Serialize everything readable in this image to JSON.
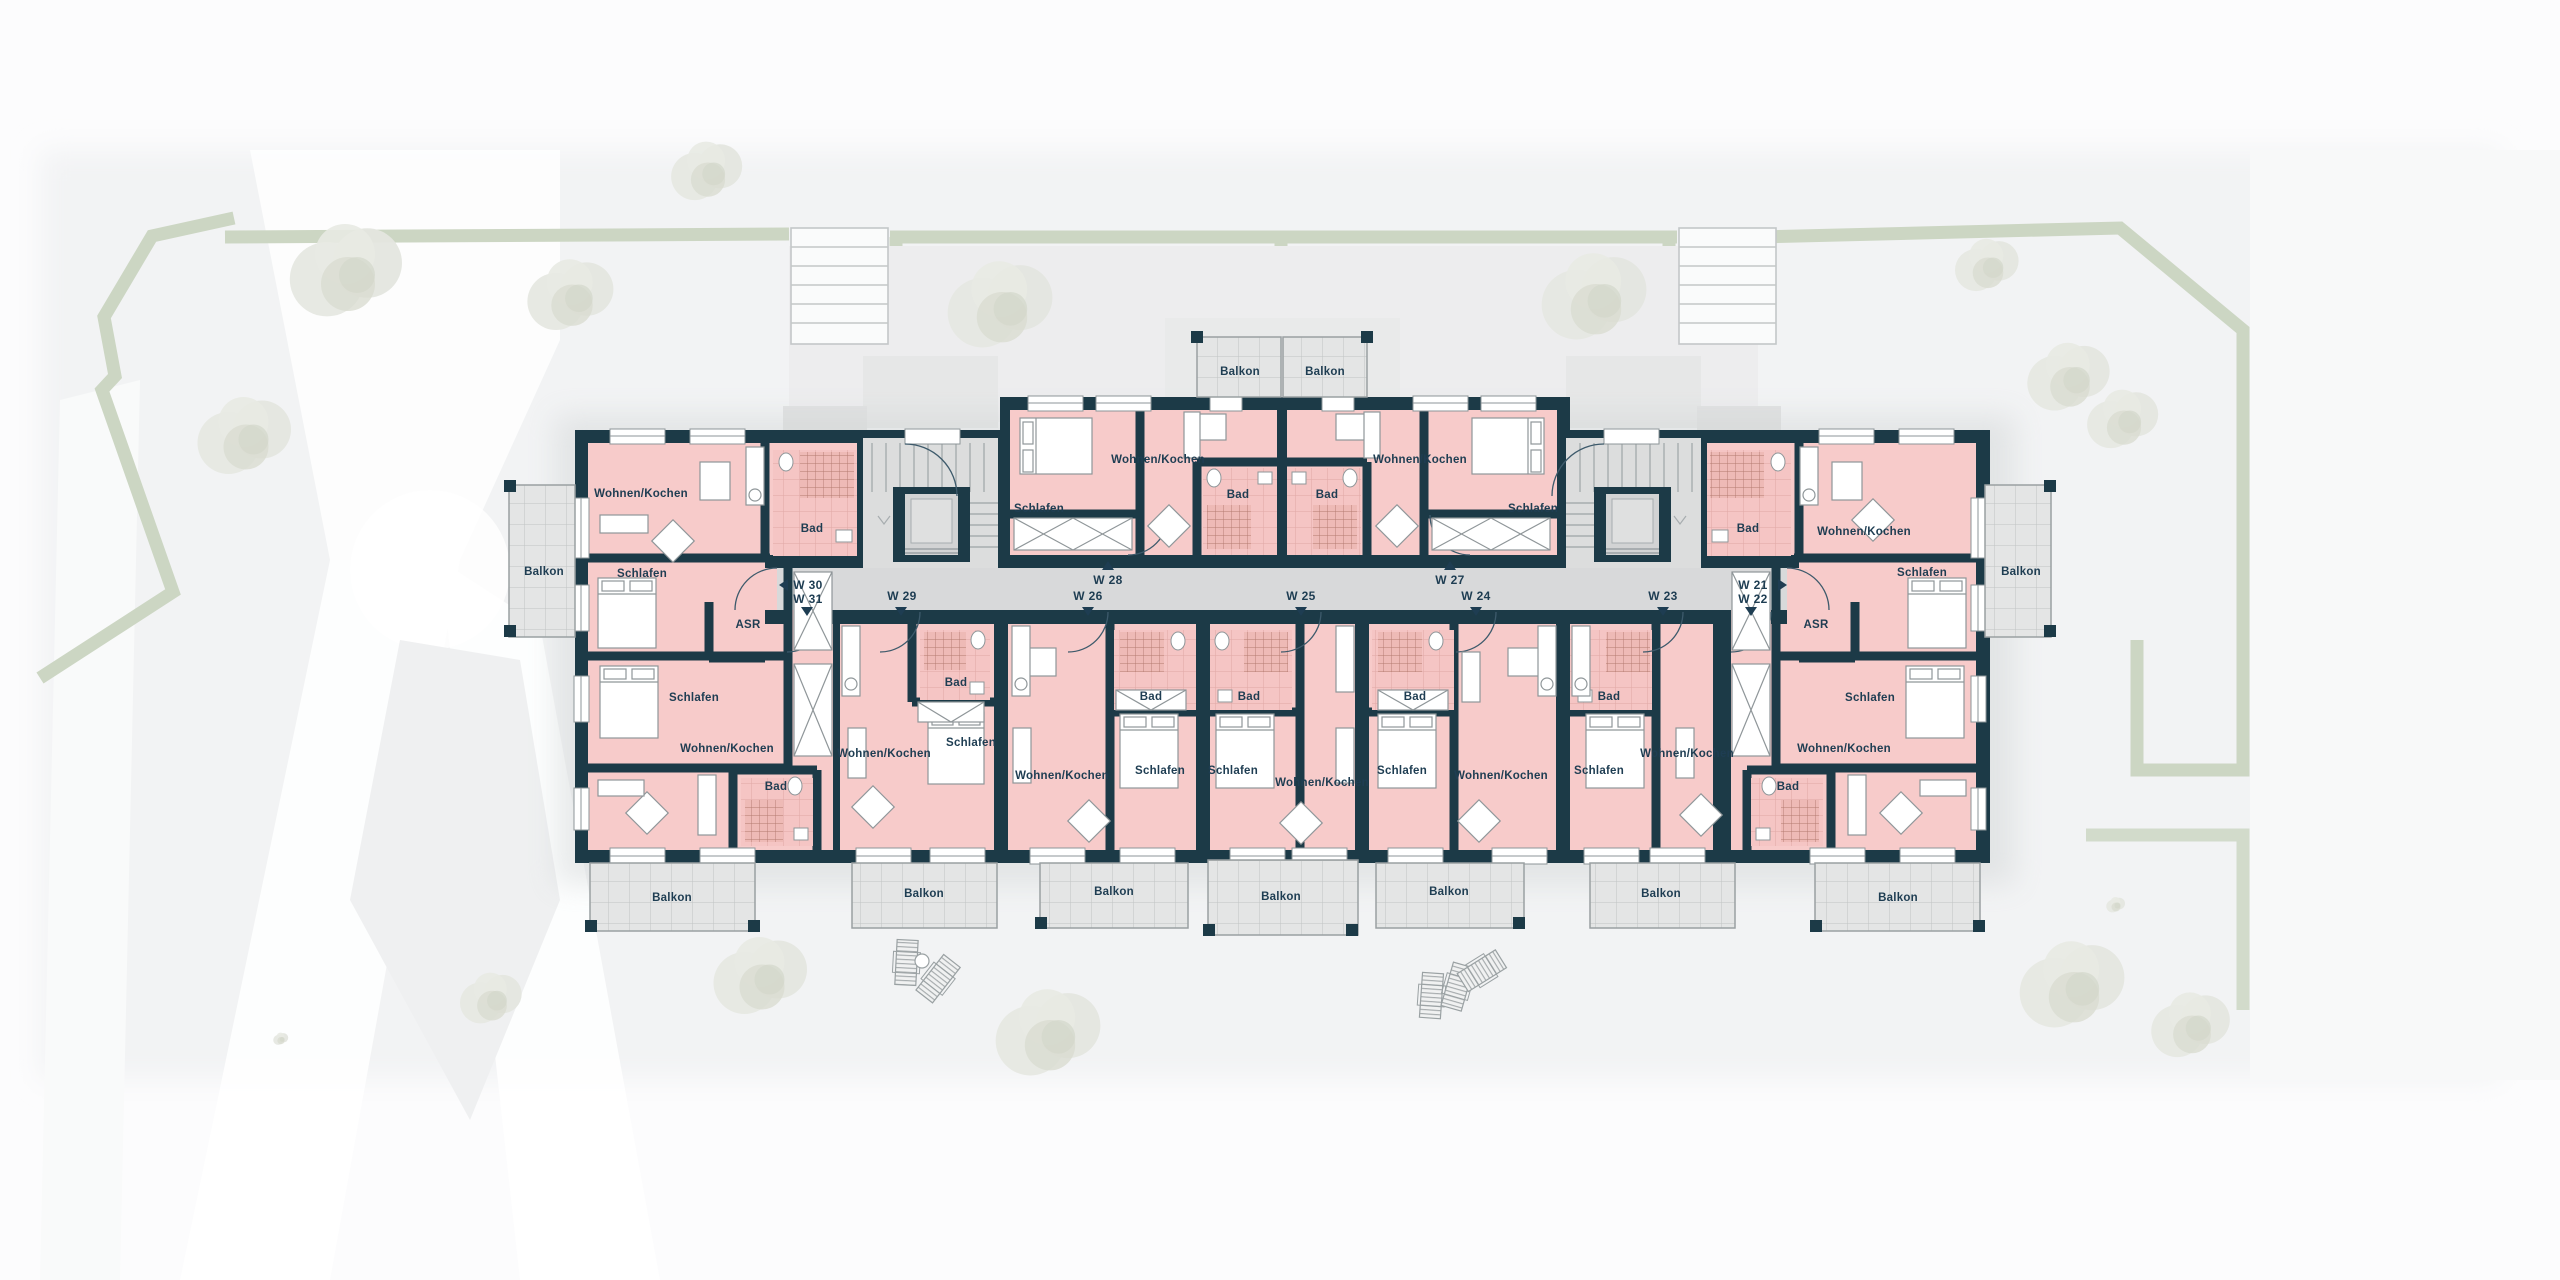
{
  "title": "Obergeschoss Wohnungsplan W21-W31",
  "colors": {
    "wall": "#1c3a47",
    "room_pink": "#f7cbca",
    "corridor_grey": "#d8d9da",
    "stair_grey": "#dcdddd",
    "balcony_grey": "#e4e5e5",
    "boundary_green": "#ccd6c3",
    "label_text": "#1e3d52",
    "ground": "#f2f3f4"
  },
  "plan": {
    "labels": [
      {
        "name": "room-w30-living",
        "cls": "lbl-room",
        "text": "Wohnen/Kochen",
        "x": 641,
        "y": 497
      },
      {
        "name": "room-w30-schlafen",
        "cls": "lbl-room",
        "text": "Schlafen",
        "x": 642,
        "y": 577
      },
      {
        "name": "room-w30-bad",
        "cls": "lbl-room",
        "text": "Bad",
        "x": 812,
        "y": 532
      },
      {
        "name": "room-w3031-asr",
        "cls": "lbl-room",
        "text": "ASR",
        "x": 748,
        "y": 628
      },
      {
        "name": "room-w31-schlafen",
        "cls": "lbl-room",
        "text": "Schlafen",
        "x": 694,
        "y": 701
      },
      {
        "name": "room-w31-living",
        "cls": "lbl-room",
        "text": "Wohnen/Kochen",
        "x": 727,
        "y": 752
      },
      {
        "name": "room-w31-bad",
        "cls": "lbl-room",
        "text": "Bad",
        "x": 776,
        "y": 790
      },
      {
        "name": "room-w29-living",
        "cls": "lbl-room",
        "text": "Wohnen/Kochen",
        "x": 884,
        "y": 757
      },
      {
        "name": "room-w29-bad",
        "cls": "lbl-room",
        "text": "Bad",
        "x": 956,
        "y": 686
      },
      {
        "name": "room-w29-schlafen",
        "cls": "lbl-room",
        "text": "Schlafen",
        "x": 971,
        "y": 746
      },
      {
        "name": "room-w26-living",
        "cls": "lbl-room",
        "text": "Wohnen/Kochen",
        "x": 1062,
        "y": 779
      },
      {
        "name": "room-w26-bad",
        "cls": "lbl-room",
        "text": "Bad",
        "x": 1151,
        "y": 700
      },
      {
        "name": "room-w26-schlafen",
        "cls": "lbl-room",
        "text": "Schlafen",
        "x": 1160,
        "y": 774
      },
      {
        "name": "room-w25-bad",
        "cls": "lbl-room",
        "text": "Bad",
        "x": 1249,
        "y": 700
      },
      {
        "name": "room-w25-schlafen",
        "cls": "lbl-room",
        "text": "Schlafen",
        "x": 1233,
        "y": 774
      },
      {
        "name": "room-w25-living",
        "cls": "lbl-room",
        "text": "Wohnen/Kochen",
        "x": 1322,
        "y": 786
      },
      {
        "name": "room-w24-bad",
        "cls": "lbl-room",
        "text": "Bad",
        "x": 1415,
        "y": 700
      },
      {
        "name": "room-w24-schlafen",
        "cls": "lbl-room",
        "text": "Schlafen",
        "x": 1402,
        "y": 774
      },
      {
        "name": "room-w24-living",
        "cls": "lbl-room",
        "text": "Wohnen/Kochen",
        "x": 1501,
        "y": 779
      },
      {
        "name": "room-w23-bad",
        "cls": "lbl-room",
        "text": "Bad",
        "x": 1609,
        "y": 700
      },
      {
        "name": "room-w23-schlafen",
        "cls": "lbl-room",
        "text": "Schlafen",
        "x": 1599,
        "y": 774
      },
      {
        "name": "room-w23-living",
        "cls": "lbl-room",
        "text": "Wohnen/Kochen",
        "x": 1687,
        "y": 757
      },
      {
        "name": "room-w28-schlafen",
        "cls": "lbl-room",
        "text": "Schlafen",
        "x": 1039,
        "y": 512
      },
      {
        "name": "room-w28-living",
        "cls": "lbl-room",
        "text": "Wohnen/Kochen",
        "x": 1158,
        "y": 463
      },
      {
        "name": "room-w28-bad",
        "cls": "lbl-room",
        "text": "Bad",
        "x": 1238,
        "y": 498
      },
      {
        "name": "room-w27-bad",
        "cls": "lbl-room",
        "text": "Bad",
        "x": 1327,
        "y": 498
      },
      {
        "name": "room-w27-living",
        "cls": "lbl-room",
        "text": "Wohnen/Kochen",
        "x": 1420,
        "y": 463
      },
      {
        "name": "room-w27-schlafen",
        "cls": "lbl-room",
        "text": "Schlafen",
        "x": 1533,
        "y": 512
      },
      {
        "name": "room-w21-living",
        "cls": "lbl-room",
        "text": "Wohnen/Kochen",
        "x": 1864,
        "y": 535
      },
      {
        "name": "room-w21-bad",
        "cls": "lbl-room",
        "text": "Bad",
        "x": 1748,
        "y": 532
      },
      {
        "name": "room-w21-schlafen",
        "cls": "lbl-room",
        "text": "Schlafen",
        "x": 1922,
        "y": 576
      },
      {
        "name": "room-w2122-asr",
        "cls": "lbl-room",
        "text": "ASR",
        "x": 1816,
        "y": 628
      },
      {
        "name": "room-w22-schlafen",
        "cls": "lbl-room",
        "text": "Schlafen",
        "x": 1870,
        "y": 701
      },
      {
        "name": "room-w22-living",
        "cls": "lbl-room",
        "text": "Wohnen/Kochen",
        "x": 1844,
        "y": 752
      },
      {
        "name": "room-w22-bad",
        "cls": "lbl-room",
        "text": "Bad",
        "x": 1788,
        "y": 790
      },
      {
        "name": "unit-w30",
        "cls": "lbl-unit",
        "text": "W 30",
        "x": 808,
        "y": 589
      },
      {
        "name": "unit-w31",
        "cls": "lbl-unit",
        "text": "W 31",
        "x": 808,
        "y": 603
      },
      {
        "name": "unit-w29",
        "cls": "lbl-unit",
        "text": "W 29",
        "x": 902,
        "y": 600
      },
      {
        "name": "unit-w26",
        "cls": "lbl-unit",
        "text": "W 26",
        "x": 1088,
        "y": 600
      },
      {
        "name": "unit-w28",
        "cls": "lbl-unit",
        "text": "W 28",
        "x": 1108,
        "y": 584
      },
      {
        "name": "unit-w25",
        "cls": "lbl-unit",
        "text": "W 25",
        "x": 1301,
        "y": 600
      },
      {
        "name": "unit-w27",
        "cls": "lbl-unit",
        "text": "W 27",
        "x": 1450,
        "y": 584
      },
      {
        "name": "unit-w24",
        "cls": "lbl-unit",
        "text": "W 24",
        "x": 1476,
        "y": 600
      },
      {
        "name": "unit-w23",
        "cls": "lbl-unit",
        "text": "W 23",
        "x": 1663,
        "y": 600
      },
      {
        "name": "unit-w21",
        "cls": "lbl-unit",
        "text": "W 21",
        "x": 1753,
        "y": 589
      },
      {
        "name": "unit-w22",
        "cls": "lbl-unit",
        "text": "W 22",
        "x": 1753,
        "y": 603
      },
      {
        "name": "balcony-left",
        "cls": "lbl-balcony",
        "text": "Balkon",
        "x": 544,
        "y": 575
      },
      {
        "name": "balcony-right",
        "cls": "lbl-balcony",
        "text": "Balkon",
        "x": 2021,
        "y": 575
      },
      {
        "name": "balcony-top-w28",
        "cls": "lbl-balcony",
        "text": "Balkon",
        "x": 1240,
        "y": 375
      },
      {
        "name": "balcony-top-w27",
        "cls": "lbl-balcony",
        "text": "Balkon",
        "x": 1325,
        "y": 375
      },
      {
        "name": "balcony-b1",
        "cls": "lbl-balcony",
        "text": "Balkon",
        "x": 672,
        "y": 901
      },
      {
        "name": "balcony-b2",
        "cls": "lbl-balcony",
        "text": "Balkon",
        "x": 924,
        "y": 897
      },
      {
        "name": "balcony-b3",
        "cls": "lbl-balcony",
        "text": "Balkon",
        "x": 1114,
        "y": 895
      },
      {
        "name": "balcony-b4",
        "cls": "lbl-balcony",
        "text": "Balkon",
        "x": 1281,
        "y": 900
      },
      {
        "name": "balcony-b5",
        "cls": "lbl-balcony",
        "text": "Balkon",
        "x": 1449,
        "y": 895
      },
      {
        "name": "balcony-b6",
        "cls": "lbl-balcony",
        "text": "Balkon",
        "x": 1661,
        "y": 897
      },
      {
        "name": "balcony-b7",
        "cls": "lbl-balcony",
        "text": "Balkon",
        "x": 1898,
        "y": 901
      }
    ],
    "arrows": [
      {
        "name": "entry-arrow-w30",
        "dir": "left",
        "x": 784,
        "y": 585
      },
      {
        "name": "entry-arrow-w31",
        "dir": "down",
        "x": 807,
        "y": 611
      },
      {
        "name": "entry-arrow-w29",
        "dir": "down",
        "x": 901,
        "y": 611
      },
      {
        "name": "entry-arrow-w26",
        "dir": "down",
        "x": 1088,
        "y": 611
      },
      {
        "name": "entry-arrow-w28",
        "dir": "up",
        "x": 1108,
        "y": 566
      },
      {
        "name": "entry-arrow-w25",
        "dir": "down",
        "x": 1301,
        "y": 611
      },
      {
        "name": "entry-arrow-w27",
        "dir": "up",
        "x": 1450,
        "y": 566
      },
      {
        "name": "entry-arrow-w24",
        "dir": "down",
        "x": 1476,
        "y": 611
      },
      {
        "name": "entry-arrow-w23",
        "dir": "down",
        "x": 1663,
        "y": 611
      },
      {
        "name": "entry-arrow-w21",
        "dir": "right",
        "x": 1782,
        "y": 585
      },
      {
        "name": "entry-arrow-w22",
        "dir": "down",
        "x": 1751,
        "y": 611
      }
    ]
  },
  "site": {
    "trees": [
      {
        "x": 348,
        "y": 272,
        "r": 60
      },
      {
        "x": 246,
        "y": 437,
        "r": 50
      },
      {
        "x": 572,
        "y": 296,
        "r": 46
      },
      {
        "x": 708,
        "y": 172,
        "r": 38
      },
      {
        "x": 1002,
        "y": 306,
        "r": 56
      },
      {
        "x": 1596,
        "y": 298,
        "r": 56
      },
      {
        "x": 1988,
        "y": 266,
        "r": 34
      },
      {
        "x": 2070,
        "y": 378,
        "r": 44
      },
      {
        "x": 2124,
        "y": 420,
        "r": 38
      },
      {
        "x": 2074,
        "y": 986,
        "r": 56
      },
      {
        "x": 2116,
        "y": 905,
        "r": 10
      },
      {
        "x": 2192,
        "y": 1026,
        "r": 42
      },
      {
        "x": 1050,
        "y": 1034,
        "r": 56
      },
      {
        "x": 762,
        "y": 977,
        "r": 50
      },
      {
        "x": 492,
        "y": 999,
        "r": 33
      },
      {
        "x": 281,
        "y": 1039,
        "r": 8
      }
    ],
    "furniture": [
      {
        "type": "lounger",
        "x": 896,
        "y": 940,
        "rot": 3
      },
      {
        "type": "lounger",
        "x": 928,
        "y": 956,
        "rot": 38
      },
      {
        "type": "table",
        "x": 922,
        "y": 961,
        "r": 7
      },
      {
        "type": "lounger",
        "x": 1421,
        "y": 973,
        "rot": 4
      },
      {
        "type": "lounger",
        "x": 1447,
        "y": 964,
        "rot": 16
      },
      {
        "type": "lounger",
        "x": 1472,
        "y": 948,
        "rot": 58
      }
    ]
  }
}
